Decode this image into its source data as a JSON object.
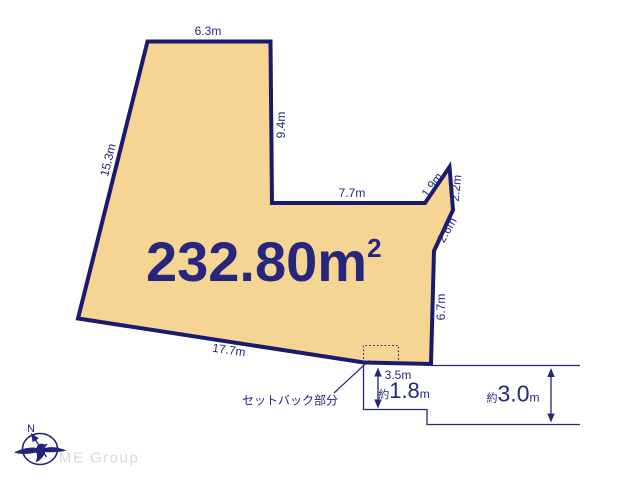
{
  "colors": {
    "outline_navy": "#1a1a6e",
    "plot_fill_tan": "#f6d494",
    "text_navy": "#26267c",
    "logo_gray": "#d9d9d9"
  },
  "area": {
    "value": "232.80",
    "unit": "m",
    "superscript": "2"
  },
  "dimensions": {
    "top": "6.3m",
    "right_upper": "9.4m",
    "left": "15.3m",
    "notch_bottom": "7.7m",
    "spike_left": "1.9m",
    "spike_right": "2.2m",
    "right_diagonal": "2.6m",
    "right_lower": "6.7m",
    "bottom": "17.7m",
    "setback_edge": "3.5m"
  },
  "roads": {
    "front": {
      "prefix": "約",
      "value": "1.8",
      "unit": "m"
    },
    "side": {
      "prefix": "約",
      "value": "3.0",
      "unit": "m"
    }
  },
  "annotations": {
    "setback": "セットバック部分"
  },
  "compass": {
    "north": "N"
  },
  "branding": {
    "logo": "ME Group"
  }
}
